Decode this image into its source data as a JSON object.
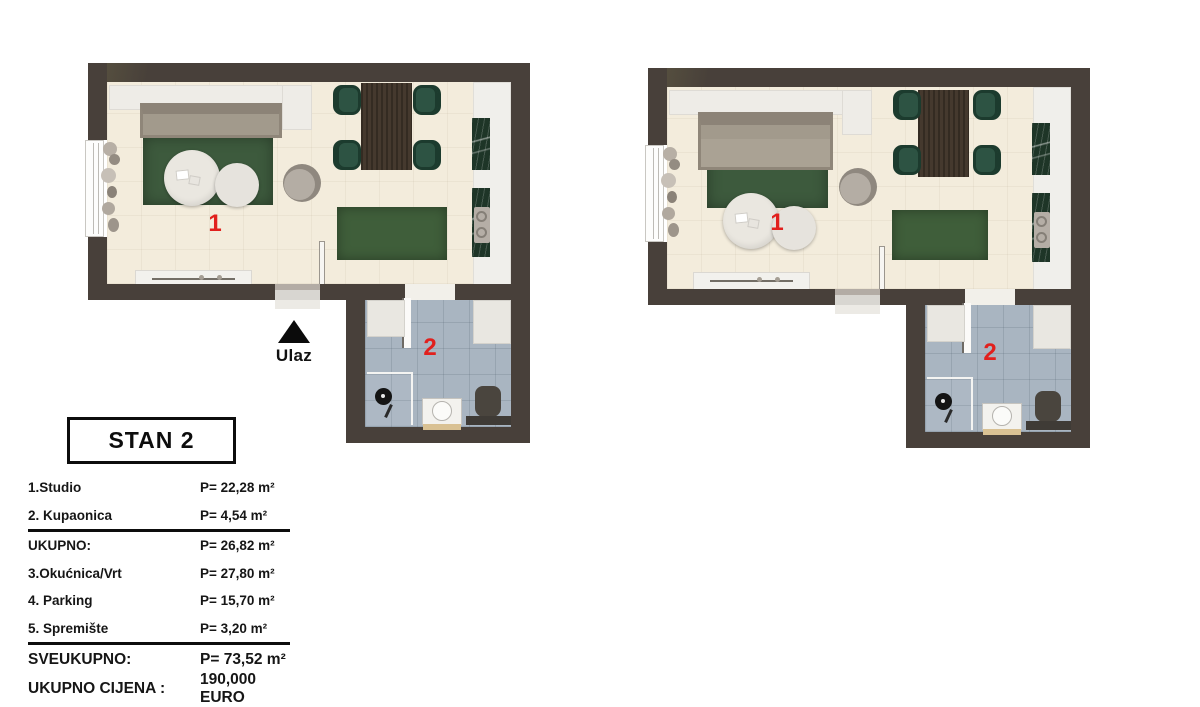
{
  "title": "STAN 2",
  "plans": [
    {
      "name": "left-floorplan",
      "studio_label": "1",
      "bathroom_label": "2",
      "entrance_label": "Ulaz"
    },
    {
      "name": "right-floorplan",
      "studio_label": "1",
      "bathroom_label": "2"
    }
  ],
  "summary": {
    "rows": [
      {
        "label": "1.Studio",
        "value": "P= 22,28 m²"
      },
      {
        "label": "2. Kupaonica",
        "value": "P= 4,54 m²"
      },
      {
        "label": "UKUPNO:",
        "value": "P= 26,82 m²"
      },
      {
        "label": "3.Okućnica/Vrt",
        "value": "P= 27,80 m²"
      },
      {
        "label": "4. Parking",
        "value": "P= 15,70 m²"
      },
      {
        "label": "5. Spremište",
        "value": "P= 3,20 m²"
      },
      {
        "label": "SVEUKUPNO:",
        "value": "P= 73,52 m²"
      },
      {
        "label": "UKUPNO CIJENA :",
        "value": "190,000 EURO"
      }
    ]
  },
  "colors": {
    "wall": "#48403a",
    "floor_main": "#f3ecdc",
    "floor_bathroom": "#a9b5c1",
    "rug_green": "#3d5a3d",
    "chair_green": "#2d5343",
    "room_number_red": "#e1201d",
    "text_black": "#0d0d0d"
  }
}
